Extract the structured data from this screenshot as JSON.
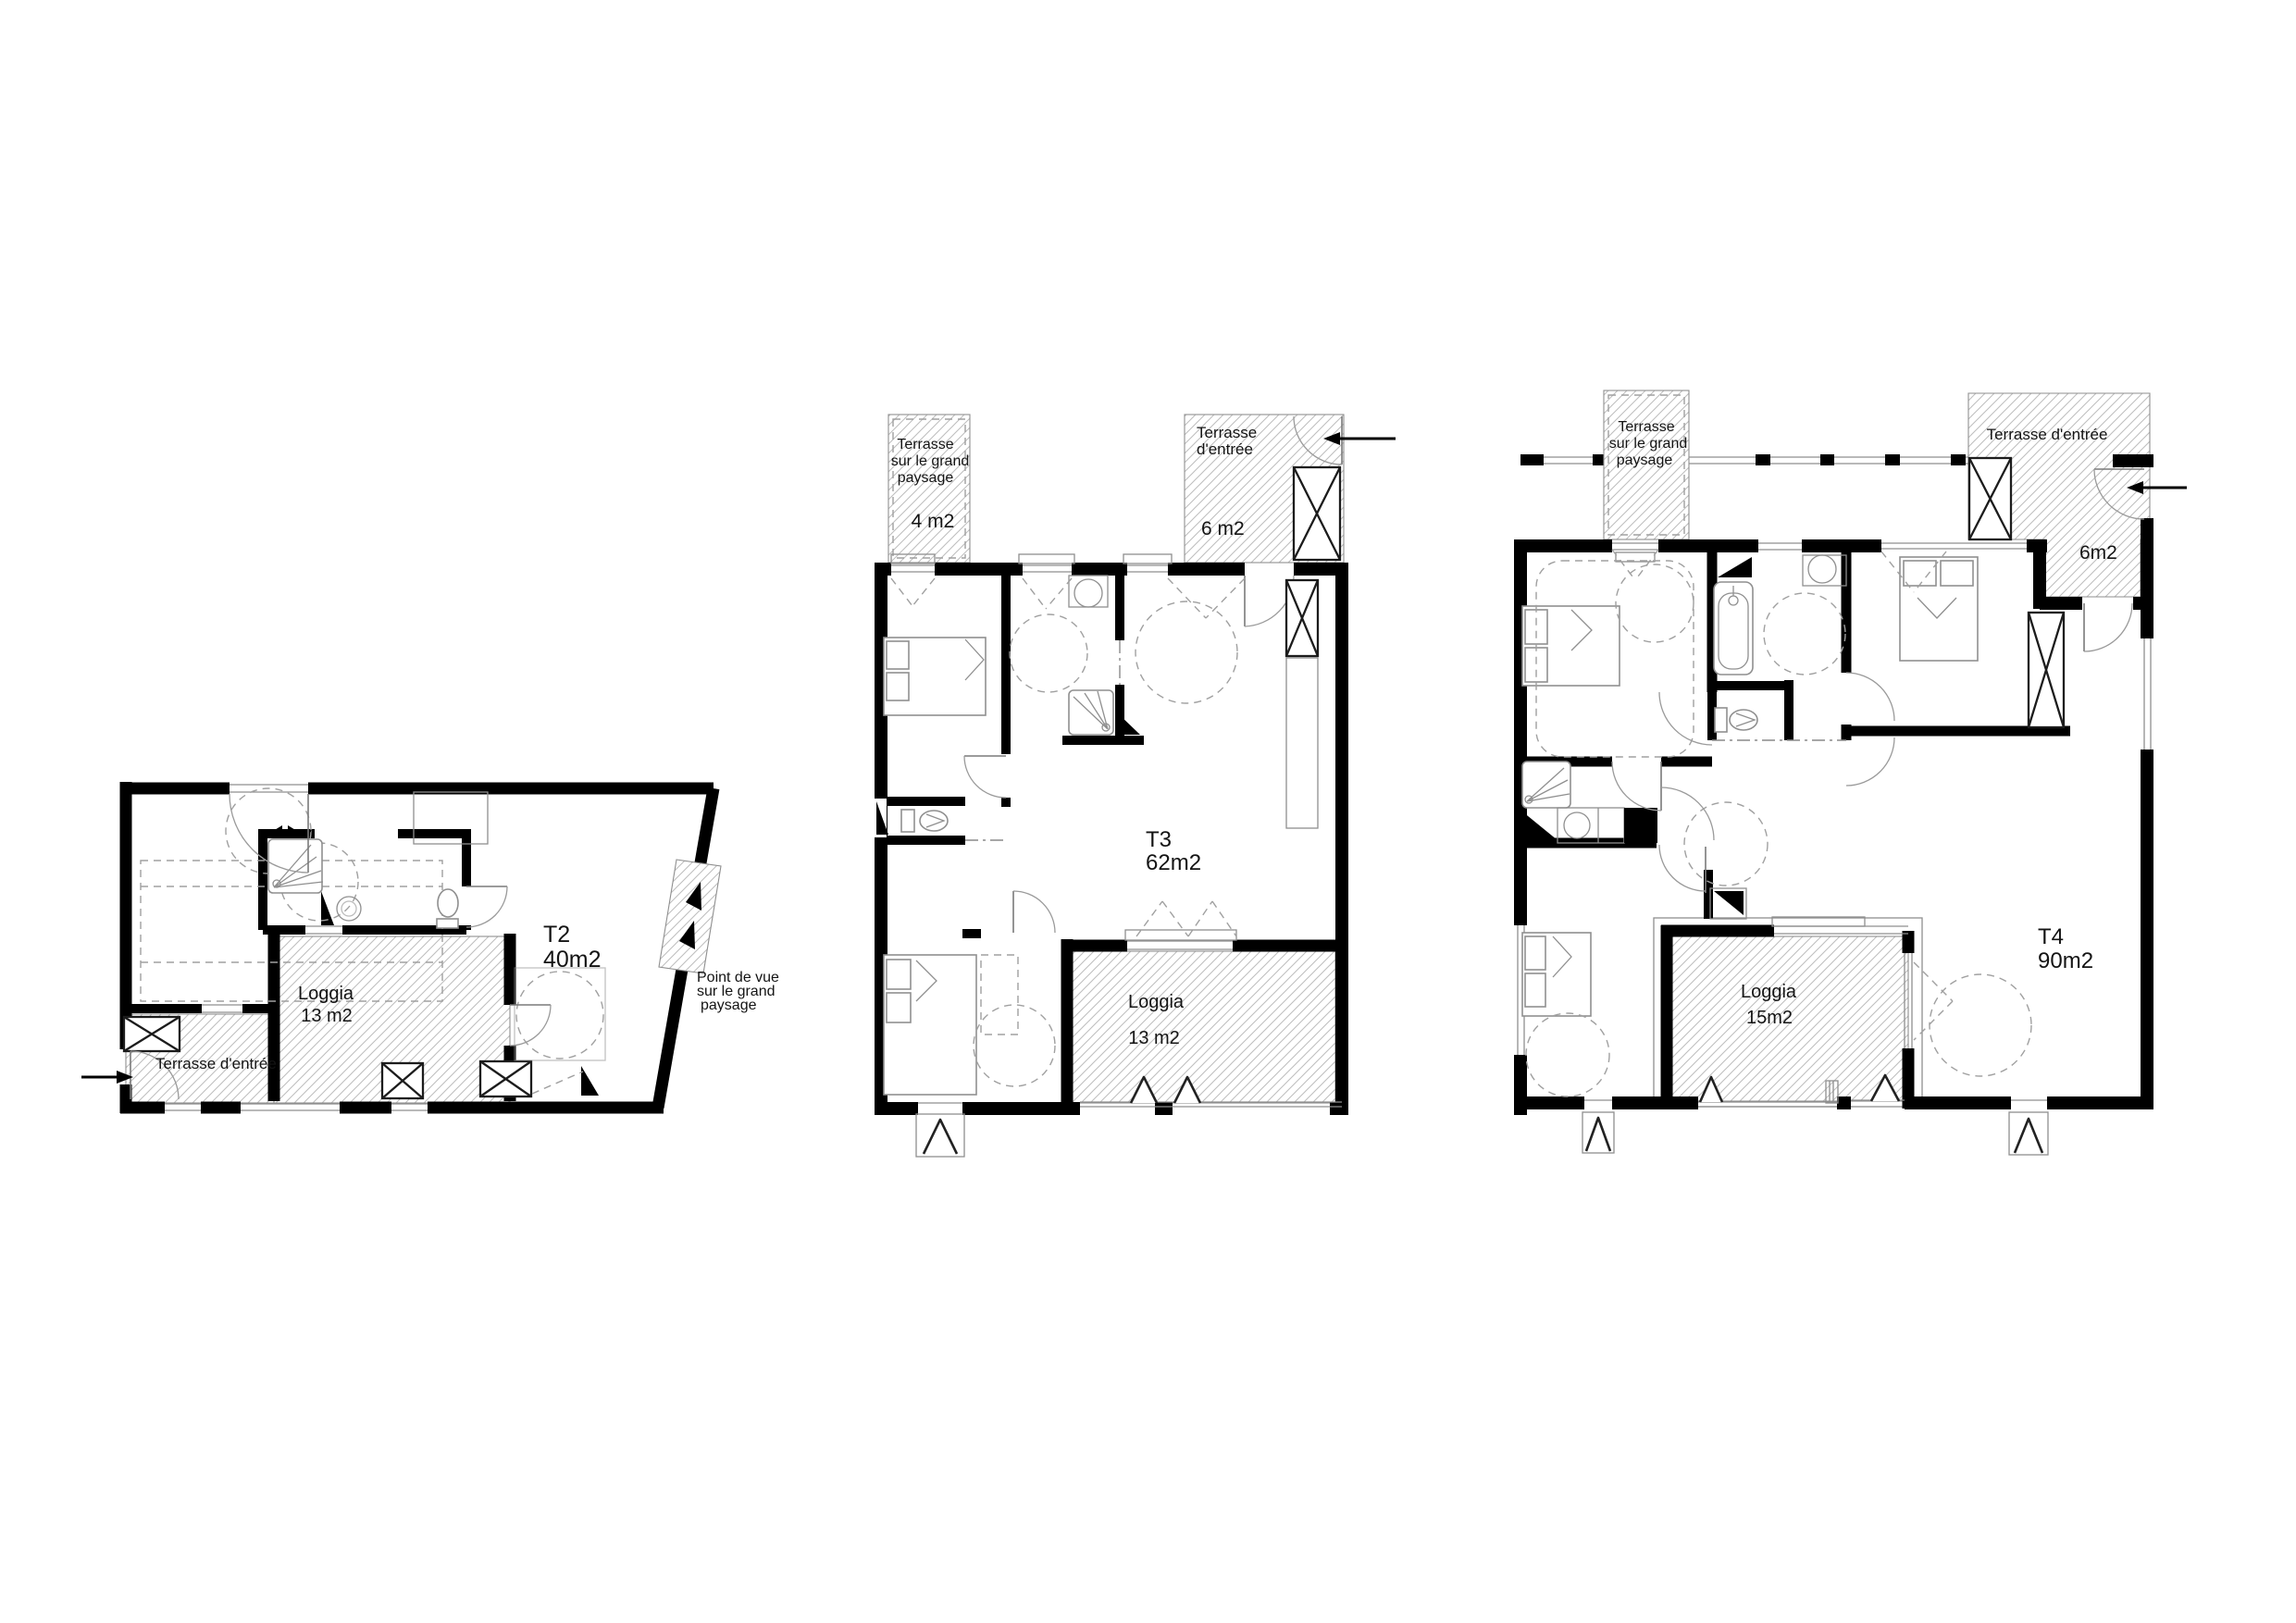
{
  "colors": {
    "wall": "#000000",
    "thin_line": "#8f8f8f",
    "hatch_line": "#bdbdbd",
    "background": "#ffffff",
    "text": "#141414"
  },
  "plans": {
    "t2": {
      "title": "T2",
      "area": "40m2",
      "loggia_title": "Loggia",
      "loggia_area": "13 m2",
      "terrace_entry": "Terrasse d'entrée",
      "viewpoint_line1": "Point de vue",
      "viewpoint_line2": "sur le grand",
      "viewpoint_line3": "paysage"
    },
    "t3": {
      "title": "T3",
      "area": "62m2",
      "loggia_title": "Loggia",
      "loggia_area": "13 m2",
      "terrace_landscape_line1": "Terrasse",
      "terrace_landscape_line2": "sur le grand",
      "terrace_landscape_line3": "paysage",
      "terrace_landscape_area": "4 m2",
      "terrace_entry_line1": "Terrasse",
      "terrace_entry_line2": "d'entrée",
      "terrace_entry_area": "6 m2"
    },
    "t4": {
      "title": "T4",
      "area": "90m2",
      "loggia_title": "Loggia",
      "loggia_area": "15m2",
      "terrace_landscape_line1": "Terrasse",
      "terrace_landscape_line2": "sur le grand",
      "terrace_landscape_line3": "paysage",
      "terrace_entry": "Terrasse d'entrée",
      "terrace_entry_area": "6m2"
    }
  }
}
